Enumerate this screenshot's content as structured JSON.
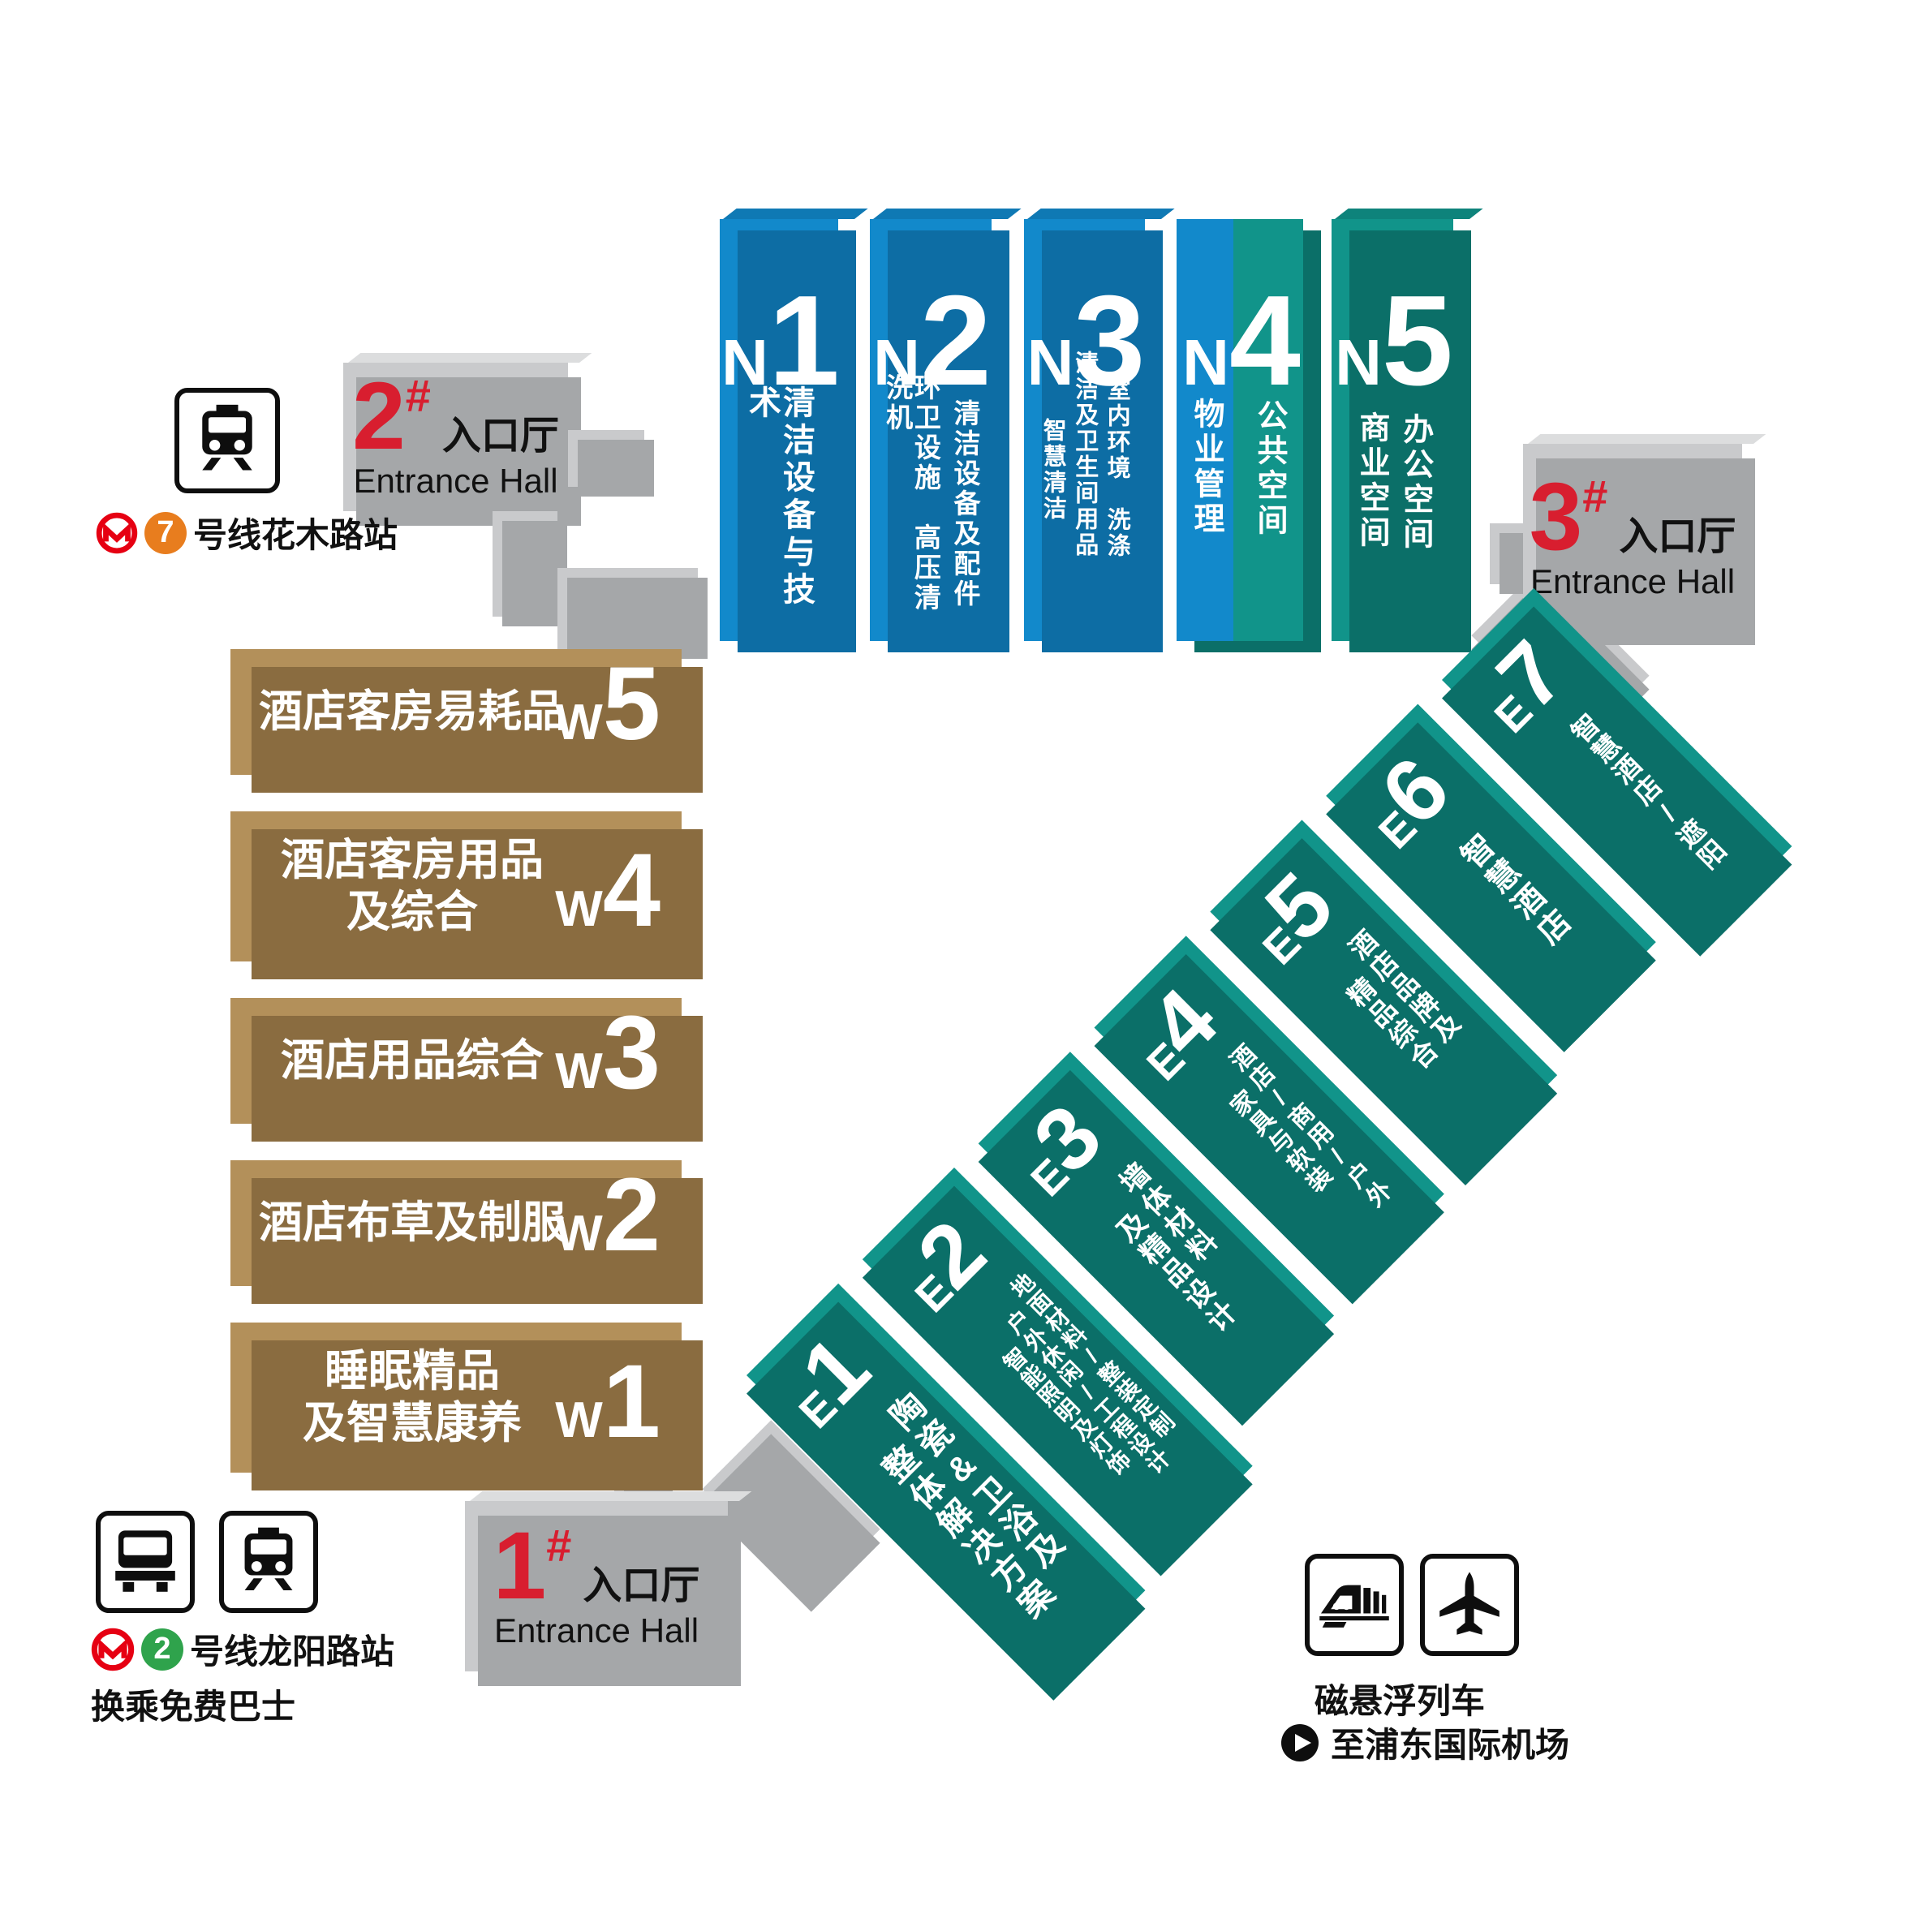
{
  "colors": {
    "blue": "#1289cb",
    "blue_dark": "#0d6da4",
    "blue_top": "#0f79b4",
    "teal": "#11948a",
    "teal_dark": "#0b6f68",
    "teal_top": "#0e837b",
    "gold": "#b3905a",
    "gold_dark": "#8a6c40",
    "gray": "#c9cacc",
    "gray_dark": "#a5a7a9",
    "gray_top": "#dcddde",
    "red": "#d81e2f",
    "metro_red": "#e60012",
    "line7_orange": "#e87d1e",
    "line2_green": "#2fa34c"
  },
  "n_halls": {
    "n1": {
      "letter": "N",
      "digit": "1",
      "col1": "清洁设备与技术"
    },
    "n2": {
      "letter": "N",
      "digit": "2",
      "col1": "环卫设施　高压清洗机",
      "col2": "清洁设备及配件"
    },
    "n3": {
      "letter": "N",
      "digit": "3",
      "col1": "智慧清洁",
      "col2": "清洁及卫生间用品",
      "col3": "室内环境　洗涤"
    },
    "n4": {
      "letter": "N",
      "digit": "4",
      "left": "物业管理",
      "right": "公共空间"
    },
    "n5": {
      "letter": "N",
      "digit": "5",
      "col1": "商业空间",
      "col2": "办公空间"
    }
  },
  "w_halls": {
    "w5": {
      "letter": "W",
      "digit": "5",
      "line1": "酒店客房易耗品",
      "line2": ""
    },
    "w4": {
      "letter": "W",
      "digit": "4",
      "line1": "酒店客房用品",
      "line2": "及综合"
    },
    "w3": {
      "letter": "W",
      "digit": "3",
      "line1": "酒店用品综合",
      "line2": ""
    },
    "w2": {
      "letter": "W",
      "digit": "2",
      "line1": "酒店布草及制服",
      "line2": ""
    },
    "w1": {
      "letter": "W",
      "digit": "1",
      "line1": "睡眠精品",
      "line2": "及智慧康养"
    }
  },
  "e_halls": {
    "e1": {
      "letter": "E",
      "digit": "1",
      "col1": "整体解决方案",
      "col2": "陶瓷&卫浴及"
    },
    "e2": {
      "letter": "E",
      "digit": "2",
      "col1": "智能照明及灯饰",
      "col2": "户外休闲/工程设计",
      "col3": "地面材料/整装定制"
    },
    "e3": {
      "letter": "E",
      "digit": "3",
      "col1": "及精品设计",
      "col2": "墙体材料"
    },
    "e4": {
      "letter": "E",
      "digit": "4",
      "col1": "家具与软装",
      "col2": "酒店/商用/户外"
    },
    "e5": {
      "letter": "E",
      "digit": "5",
      "col1": "精品综合",
      "col2": "酒店品牌及"
    },
    "e6": {
      "letter": "E",
      "digit": "6",
      "col1": "智慧酒店"
    },
    "e7": {
      "letter": "E",
      "digit": "7",
      "col1": "智慧酒店/遮阳"
    }
  },
  "entrances": {
    "no1": {
      "num": "1",
      "hash": "#",
      "cn": "入口厅",
      "en": "Entrance Hall"
    },
    "no2": {
      "num": "2",
      "hash": "#",
      "cn": "入口厅",
      "en": "Entrance Hall"
    },
    "no3": {
      "num": "3",
      "hash": "#",
      "cn": "入口厅",
      "en": "Entrance Hall"
    }
  },
  "transit": {
    "huamu": {
      "badge": "7",
      "label": "号线花木路站",
      "icon": "train-front-icon",
      "logo": "shanghai-metro-logo"
    },
    "longyang": {
      "badge": "2",
      "label": "号线龙阳路站",
      "note": "换乘免费巴士",
      "icon1": "bus-front-icon",
      "icon2": "train-front-icon"
    },
    "maglev": {
      "line1": "磁悬浮列车",
      "line2": "至浦东国际机场",
      "icon1": "maglev-train-icon",
      "icon2": "airplane-icon",
      "arrow": "play-arrow-icon"
    }
  }
}
